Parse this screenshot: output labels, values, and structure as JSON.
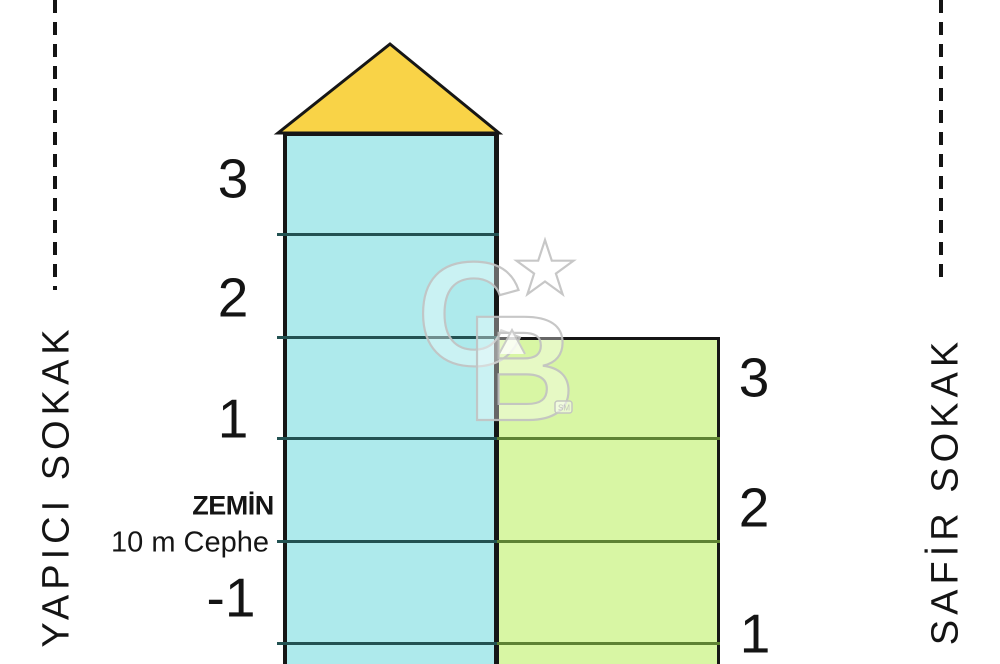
{
  "diagram": {
    "title_hint": "building-floor-elevation-diagram",
    "streets": {
      "left": "YAPICI SOKAK",
      "right": "SAFİR SOKAK"
    },
    "left_building": {
      "roof_color": "#F9D347",
      "body_color": "#AEEAEC",
      "floor_line_color": "#235252",
      "floors": {
        "f3": "3",
        "f2": "2",
        "f1": "1",
        "ground": "ZEMİN",
        "frontage": "10 m Cephe",
        "b1": "-1"
      }
    },
    "right_building": {
      "body_color": "#D8F6A4",
      "floor_line_color": "#5E8233",
      "floors": {
        "f3": "3",
        "f2": "2",
        "f1": "1"
      }
    },
    "watermark": {
      "c": "C",
      "b": "B",
      "sm": "SM"
    }
  }
}
